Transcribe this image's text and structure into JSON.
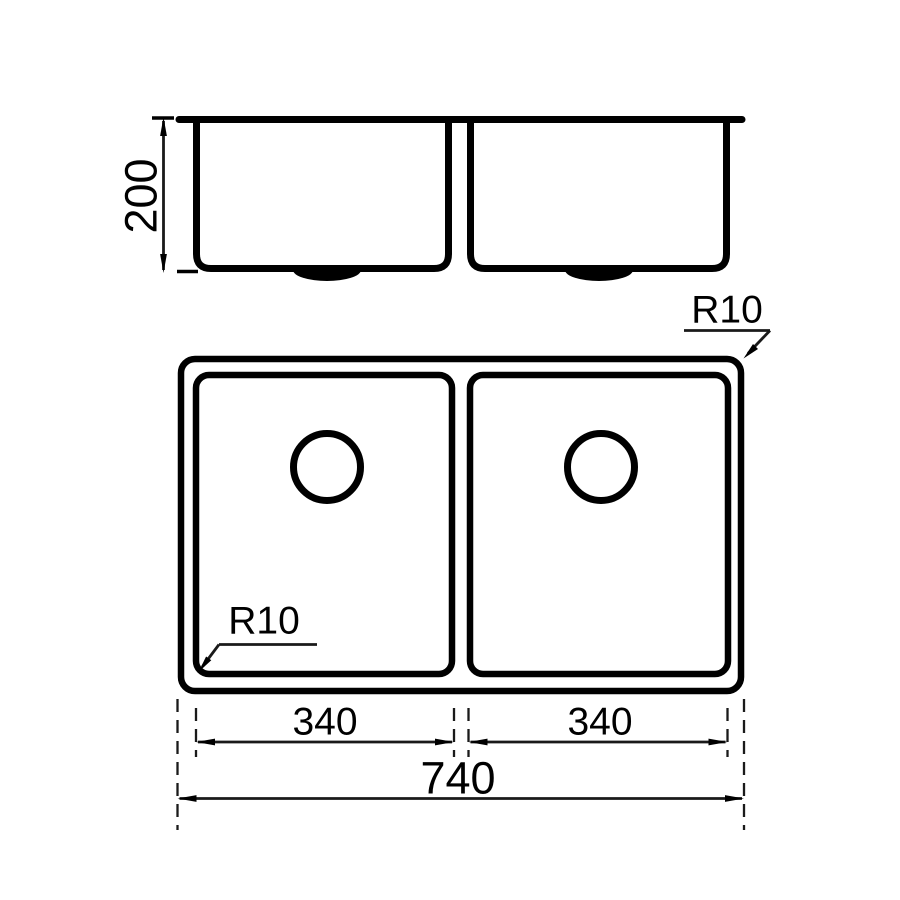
{
  "drawing": {
    "kind": "technical-drawing",
    "colors": {
      "line": "#000000",
      "background": "#ffffff"
    },
    "side_view": {
      "depth_label": "200"
    },
    "plan_view": {
      "outer_radius_label": "R10",
      "bowl_radius_label": "R10",
      "left_bowl_width_label": "340",
      "right_bowl_width_label": "340",
      "overall_width_label": "740"
    }
  }
}
